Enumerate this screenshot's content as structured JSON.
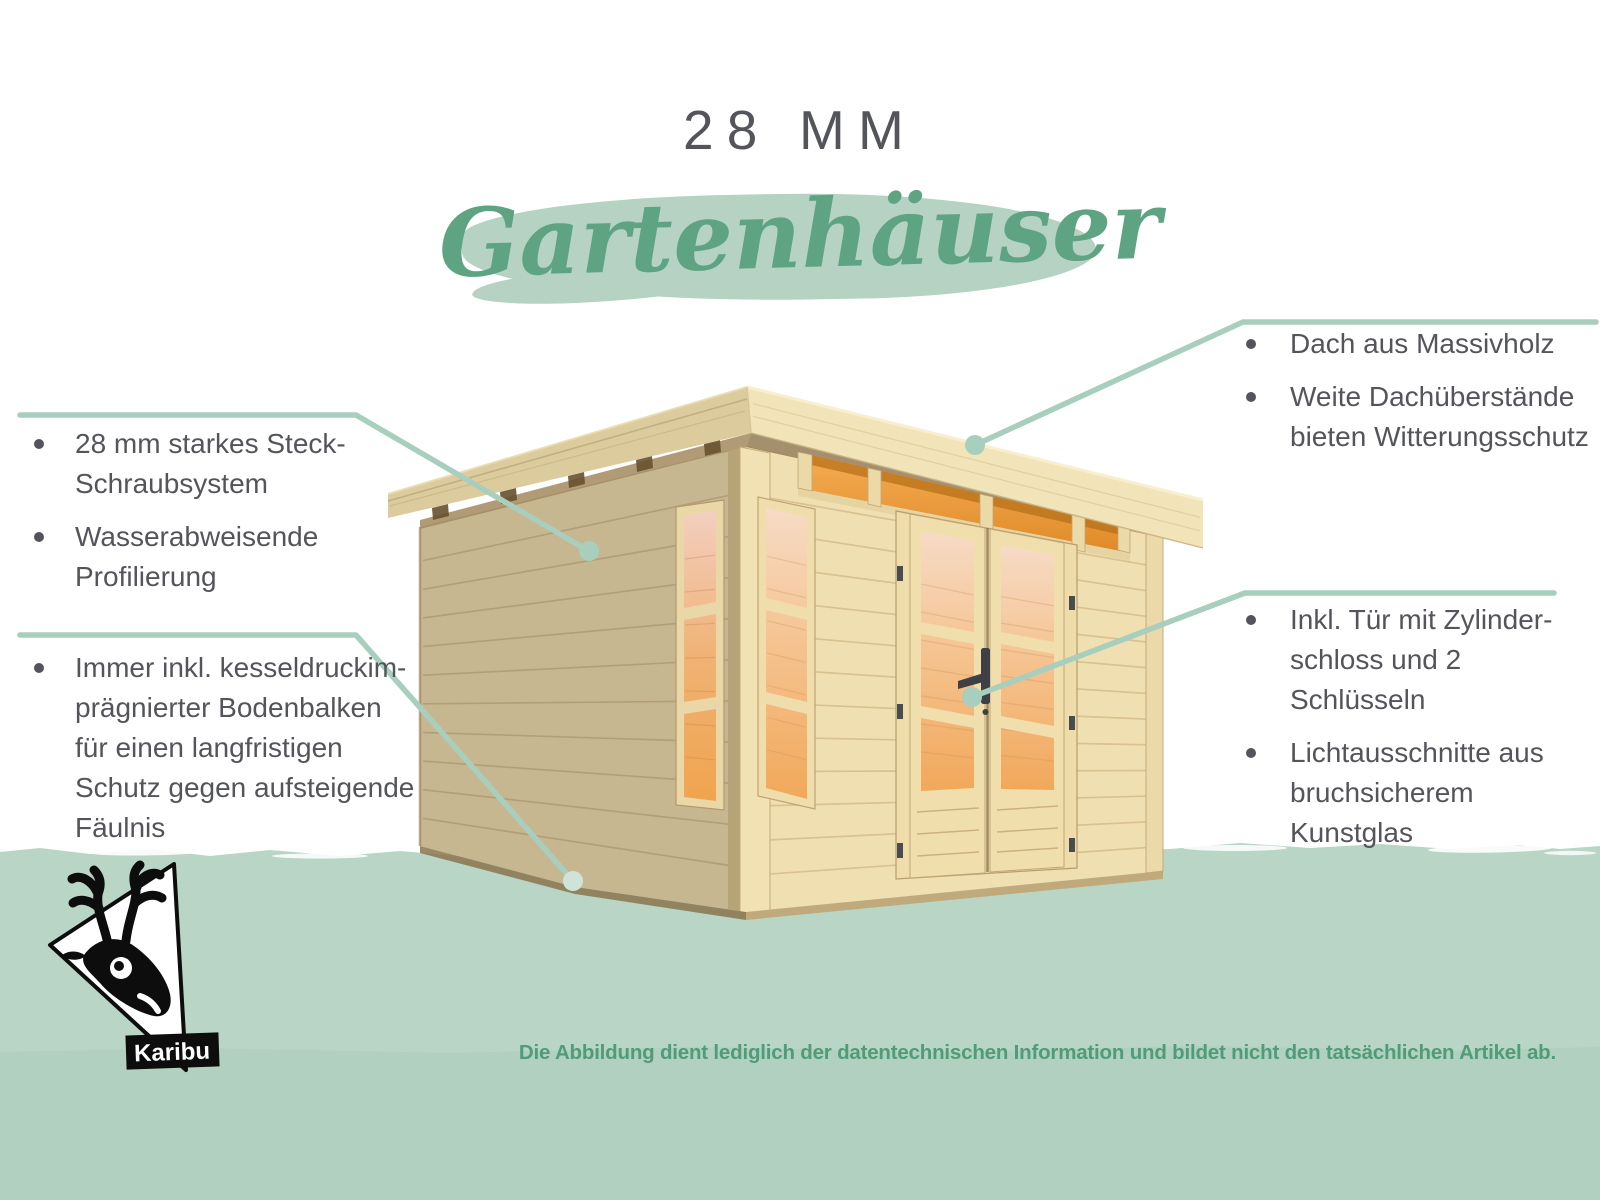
{
  "header": {
    "title": "28 MM",
    "subtitle": "Gartenhäuser"
  },
  "callouts": {
    "left_top": {
      "items": [
        {
          "text": "28 mm starkes Steck-\nSchraubsystem"
        },
        {
          "text": "Wasserabweisende\nProfilierung"
        }
      ]
    },
    "left_bottom": {
      "items": [
        {
          "text": "Immer inkl. kesseldruckim-\nprägnierter Bodenbalken\nfür einen langfristigen\nSchutz gegen aufsteigende\nFäulnis"
        }
      ]
    },
    "top_right": {
      "items": [
        {
          "text": "Dach aus Massivholz"
        },
        {
          "text": "Weite Dachüberstände\nbieten Witterungsschutz"
        }
      ]
    },
    "right_mid": {
      "items": [
        {
          "text": "Inkl. Tür mit Zylinder-\nschloss und 2 Schlüsseln"
        },
        {
          "text": "Lichtausschnitte aus\nbruchsicherem Kunstglas"
        }
      ]
    }
  },
  "footer": {
    "disclaimer": "Die Abbildung dient lediglich der datentechnischen Information und bildet nicht den tatsächlichen Artikel ab."
  },
  "logo": {
    "brand": "Karibu"
  },
  "illustration": {
    "subject": "Gartenhaus mit Flachdach"
  },
  "colors": {
    "title_text": "#53555b",
    "body_text": "#54555b",
    "script_green": "#5ea482",
    "brush_green": "#b5d2c2",
    "band_green": "#b9d5c5",
    "callout_line": "#a8cebd",
    "disclaimer_green": "#4f9c77"
  }
}
